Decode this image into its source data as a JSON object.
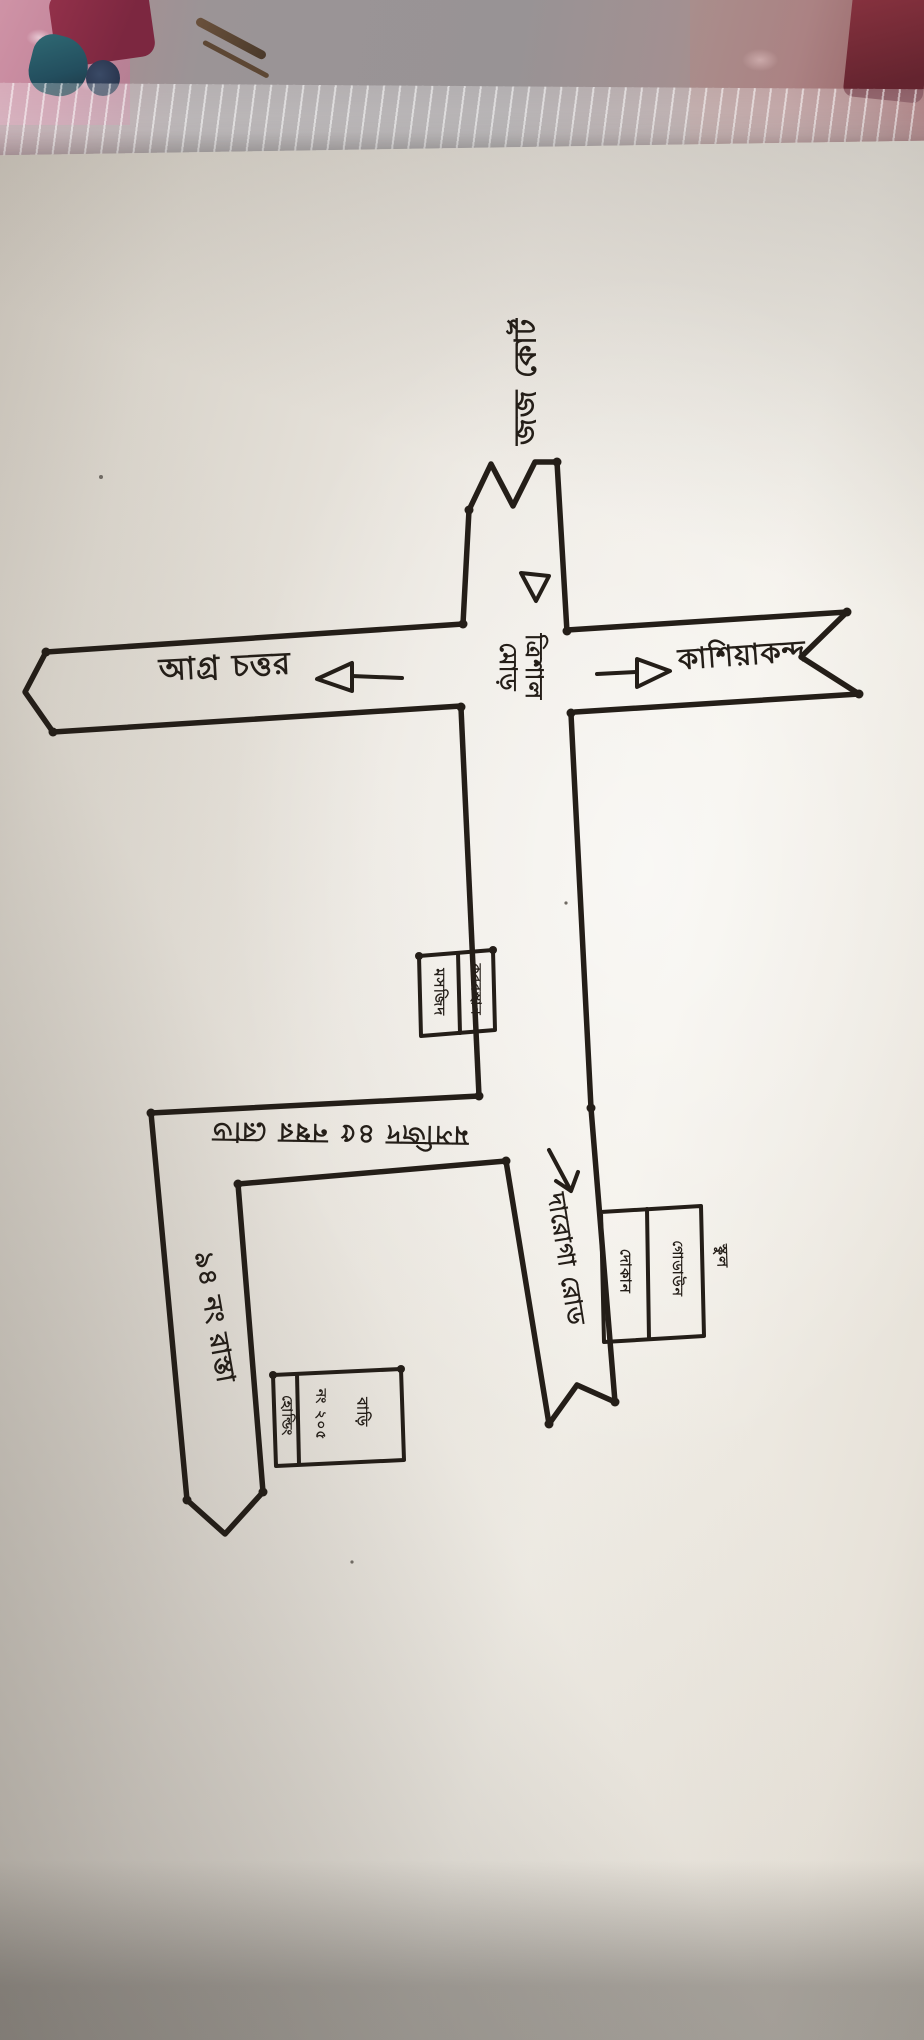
{
  "scene": {
    "type": "photograph of a hand-drawn sketch map",
    "medium": "black ink on white paper, paper lying on patterned fabric with a clear plastic sleeve edge at top"
  },
  "colors": {
    "ink": "#241e18",
    "paper": "#efece5",
    "fabric_gray": "#989395",
    "fabric_pink": "#c2849a",
    "fabric_crimson": "#7c2740",
    "fabric_teal": "#234e5e"
  },
  "map": {
    "top_destination": "জজ কোর্ট",
    "junction": {
      "line1": "ত্রিশাল",
      "line2": "মোড়"
    },
    "west_road": {
      "label": "আগ্র চত্তর",
      "arrow": "left",
      "end_mark": "chevron-continuation"
    },
    "east_road": {
      "label": "কাশিয়াকন্দ",
      "arrow": "right",
      "end_mark": "chevron-continuation"
    },
    "road_45": {
      "label": "মসজিদ ৪৫ নম্বর রোড",
      "orientation": "upside-down"
    },
    "road_94": {
      "label": "৯৪ নং রাস্তা",
      "orientation": "vertical"
    },
    "south_road": {
      "label": "দারোগা রোড",
      "arrow": "down",
      "orientation": "vertical"
    },
    "buildings": {
      "mid_left_box": {
        "cells": [
          "মসজিদ",
          "কবরস্থান"
        ]
      },
      "house_box": {
        "cells": [
          "হোল্ডিং",
          "নং ২০৫",
          "বাড়ি"
        ]
      },
      "south_box": {
        "cells": [
          "দোকান",
          "গোডাউন"
        ],
        "outside_label": "স্কুল"
      }
    }
  }
}
